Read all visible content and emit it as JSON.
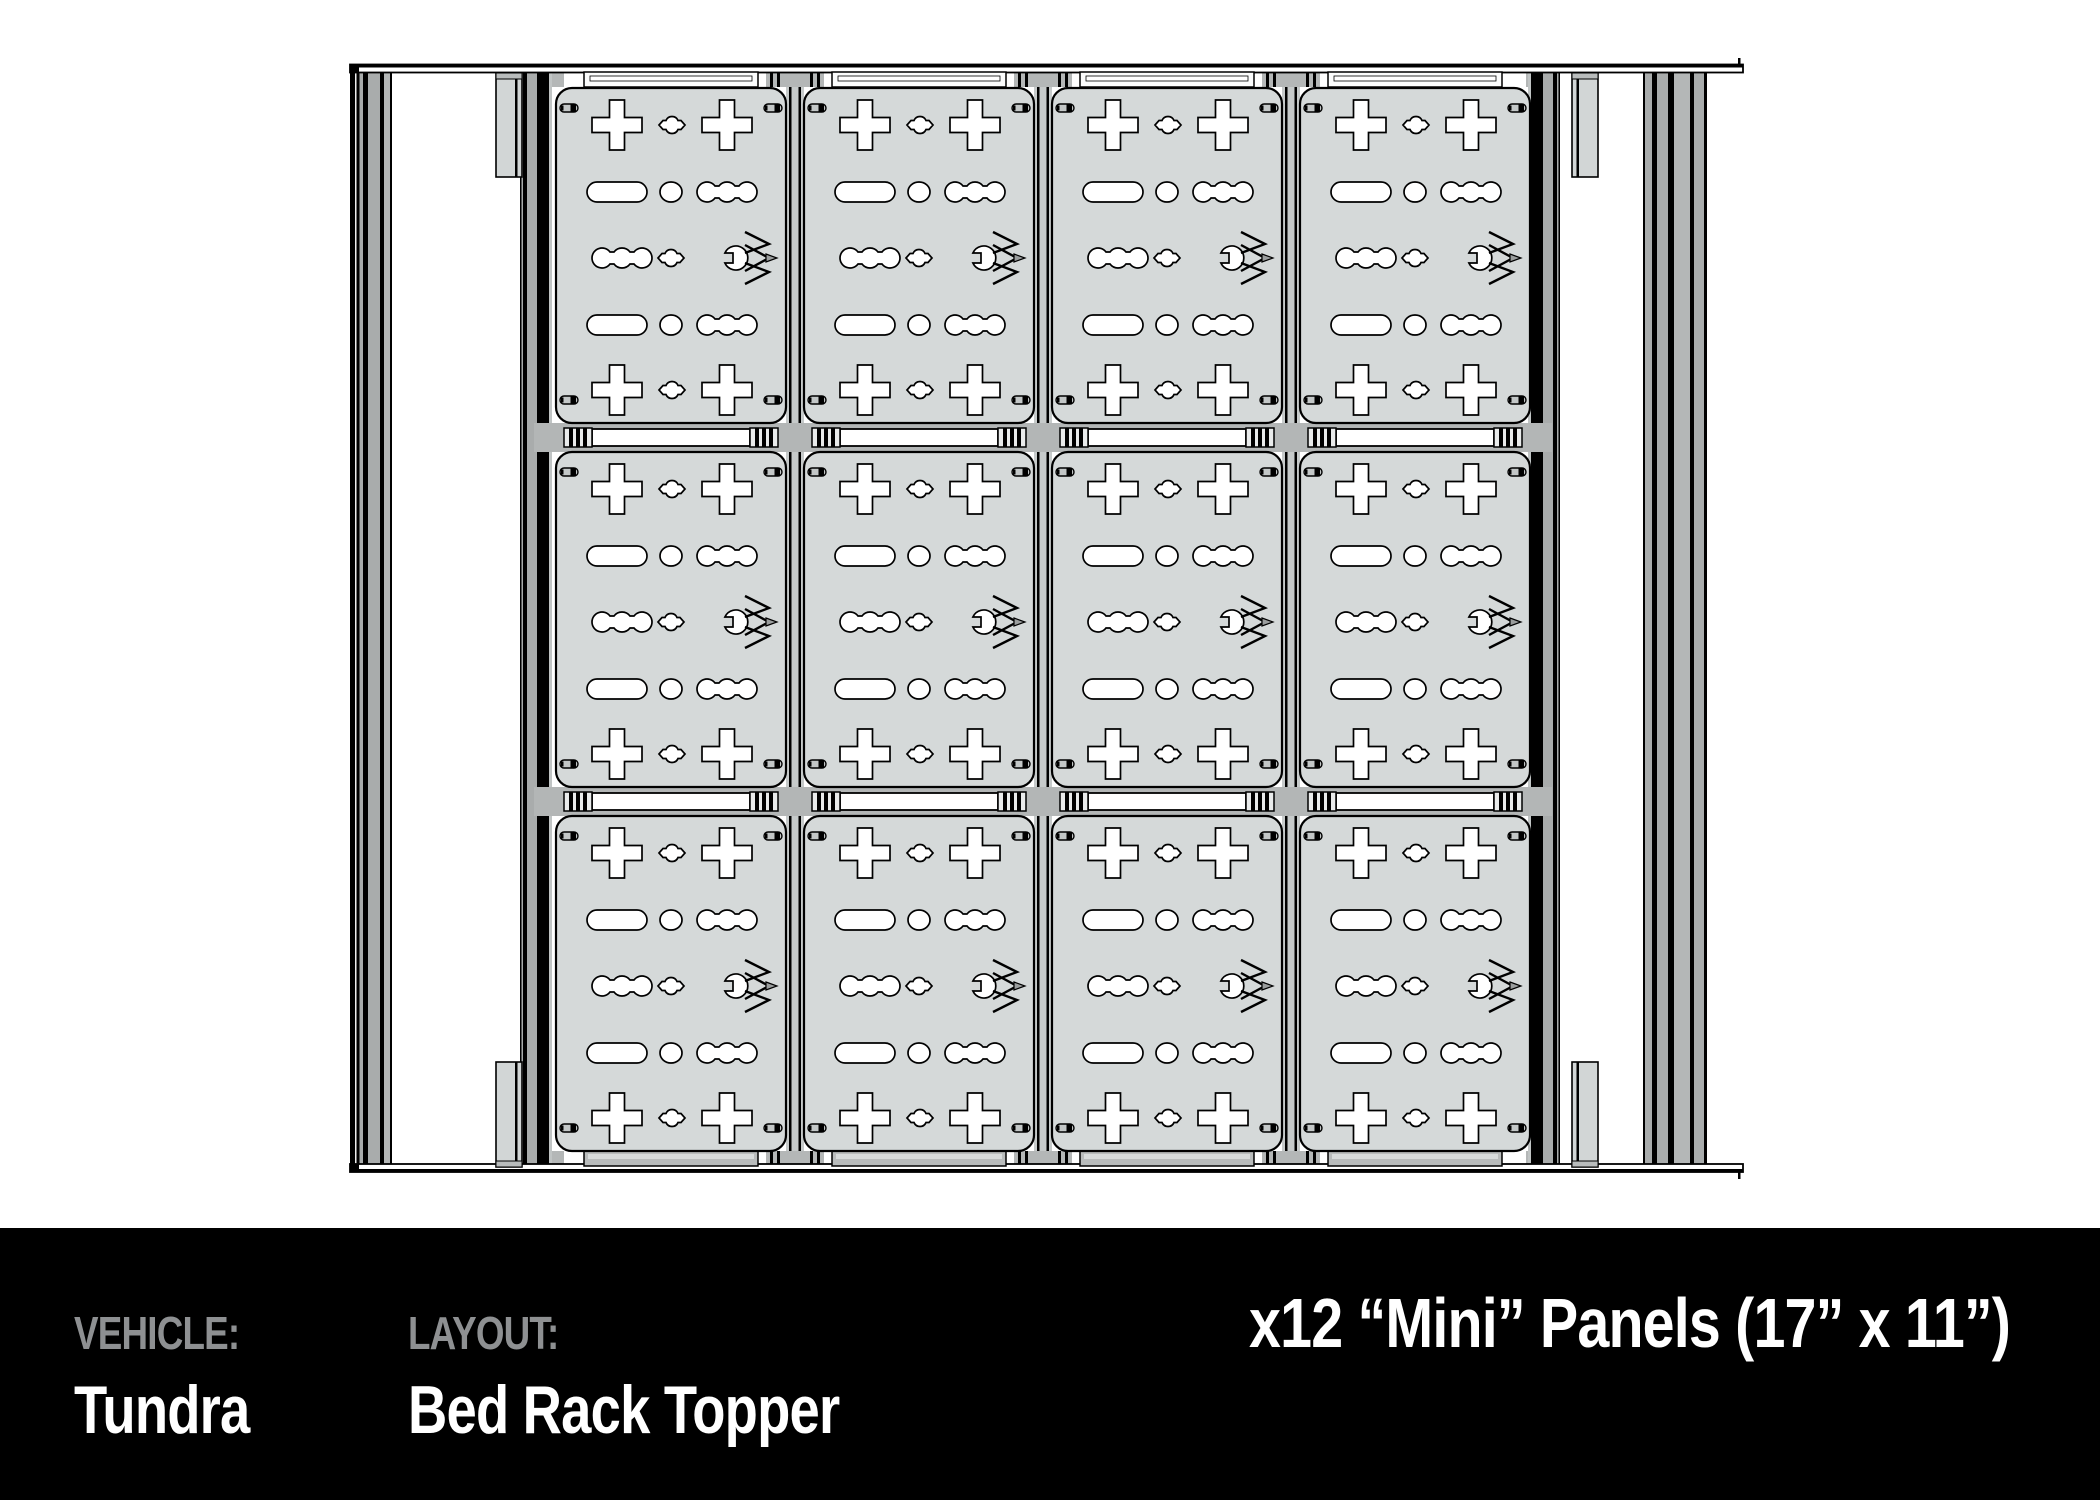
{
  "footer": {
    "vehicle_label": "VEHICLE:",
    "vehicle_value": "Tundra",
    "layout_label": "LAYOUT:",
    "layout_value": "Bed Rack Topper",
    "panels_title": "x12 “Mini” Panels (17” x 11”)"
  },
  "diagram": {
    "description": "Top-down technical drawing of a truck bed rack topper fitted with modular accessory panels",
    "grid": {
      "columns": 4,
      "rows": 3,
      "panel_count": 12
    },
    "icons": [
      "brand-chevron-logo-icon"
    ],
    "colors": {
      "background": "#ffffff",
      "panel_fill": "#d5d9d9",
      "cutout_fill": "#ffffff",
      "outline": "#000000",
      "rail_gray": "#a9acac",
      "gap_gray": "#c6caca",
      "band_gray": "#b3b6b6",
      "footer_bg": "#000000",
      "footer_label_gray": "#8e9092",
      "footer_value_white": "#ffffff"
    }
  }
}
